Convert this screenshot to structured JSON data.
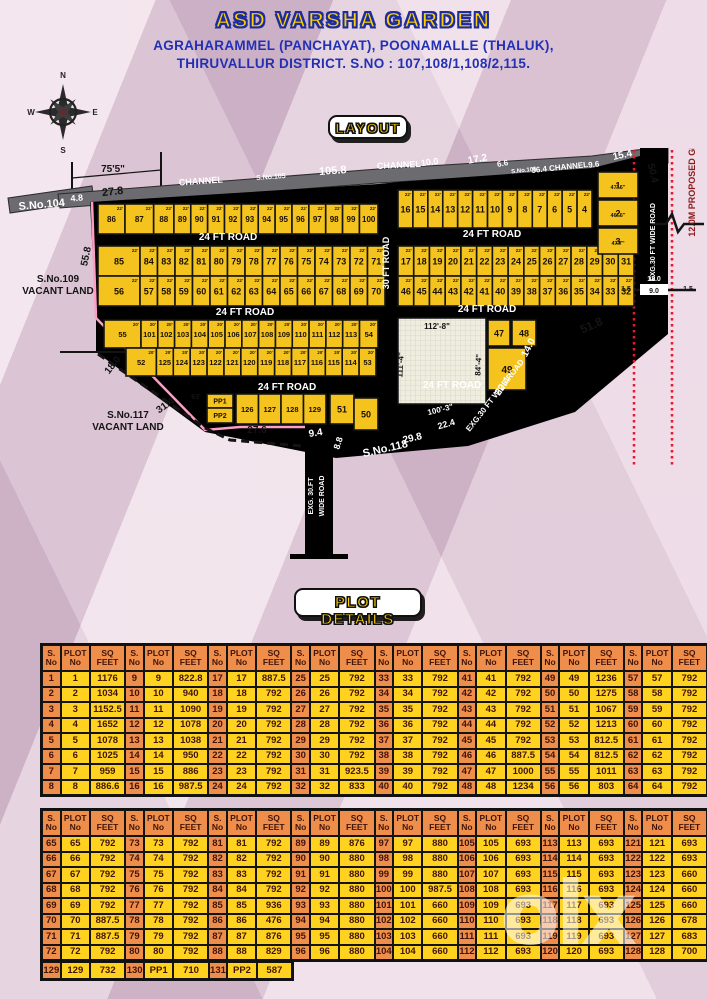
{
  "header": {
    "title": "ASD VARSHA GARDEN",
    "address_line1": "AGRAHARAMMEL (PANCHAYAT), POONAMALLE (THALUK),",
    "address_line2": "THIRUVALLUR DISTRICT.  S.NO : 107,108/1,108/2,115.",
    "layout_badge": "LAYOUT",
    "compass_points": {
      "n": "N",
      "e": "E",
      "s": "S",
      "w": "W"
    }
  },
  "colors": {
    "plot_yellow": "#f4c31d",
    "road_black": "#141414",
    "channel_grey": "#6b6b70",
    "table_orange": "#ef8d4a",
    "table_yellow": "#ffd21f",
    "boundary_pink": "#ff9dc5",
    "grid_road_red": "#e8192c",
    "title_yellow": "#ffd100",
    "title_blue": "#1d2d9e"
  },
  "map": {
    "plot_rows": [
      {
        "labels": [
          "86",
          "87",
          "88",
          "89",
          "90",
          "91",
          "92",
          "93",
          "94",
          "95",
          "96",
          "97",
          "98",
          "99",
          "100"
        ],
        "x0": 98,
        "x1": 378,
        "y": 204,
        "h": 30,
        "fs": 8,
        "w": [
          1.6,
          1.7,
          1.2,
          1,
          1,
          1,
          1,
          1,
          1,
          1,
          1,
          1,
          1,
          1,
          1.1
        ],
        "dim": "22'"
      },
      {
        "labels": [
          "16",
          "15",
          "14",
          "13",
          "12",
          "11",
          "10",
          "9",
          "8",
          "7",
          "6",
          "5",
          "4"
        ],
        "x0": 398,
        "x1": 592,
        "y": 190,
        "h": 38,
        "fs": 9,
        "dim": "22'"
      },
      {
        "labels": [
          "85",
          "84",
          "83",
          "82",
          "81",
          "80",
          "79",
          "78",
          "77",
          "76",
          "75",
          "74",
          "73",
          "72",
          "71"
        ],
        "x0": 98,
        "x1": 385,
        "y": 246,
        "h": 30,
        "fs": 9,
        "w": [
          2.4,
          1,
          1,
          1,
          1,
          1,
          1,
          1,
          1,
          1,
          1,
          1,
          1,
          1,
          1
        ],
        "dim": "22'"
      },
      {
        "labels": [
          "56",
          "57",
          "58",
          "59",
          "60",
          "61",
          "62",
          "63",
          "64",
          "65",
          "66",
          "67",
          "68",
          "69",
          "70"
        ],
        "x0": 98,
        "x1": 385,
        "y": 276,
        "h": 30,
        "fs": 9,
        "w": [
          2.4,
          1,
          1,
          1,
          1,
          1,
          1,
          1,
          1,
          1,
          1,
          1,
          1,
          1,
          1
        ],
        "dim": "22'"
      },
      {
        "labels": [
          "17",
          "18",
          "19",
          "20",
          "21",
          "22",
          "23",
          "24",
          "25",
          "26",
          "27",
          "28",
          "29",
          "30",
          "31"
        ],
        "x0": 398,
        "x1": 634,
        "y": 246,
        "h": 30,
        "fs": 9,
        "dim": "22'"
      },
      {
        "labels": [
          "46",
          "45",
          "44",
          "43",
          "42",
          "41",
          "40",
          "39",
          "38",
          "37",
          "36",
          "35",
          "34",
          "33",
          "32"
        ],
        "x0": 398,
        "x1": 634,
        "y": 276,
        "h": 30,
        "fs": 9,
        "dim": "22'"
      },
      {
        "labels": [
          "55",
          "101",
          "102",
          "103",
          "104",
          "105",
          "106",
          "107",
          "108",
          "109",
          "110",
          "111",
          "112",
          "113",
          "54"
        ],
        "x0": 104,
        "x1": 378,
        "y": 320,
        "h": 28,
        "fs": 7.5,
        "w": [
          2.2,
          1,
          1,
          1,
          1,
          1,
          1,
          1,
          1,
          1,
          1,
          1,
          1,
          1,
          1.1
        ],
        "dim": "20'"
      },
      {
        "labels": [
          "52",
          "125",
          "124",
          "123",
          "122",
          "121",
          "120",
          "119",
          "118",
          "117",
          "116",
          "115",
          "114",
          "53"
        ],
        "x0": 126,
        "x1": 376,
        "y": 348,
        "h": 28,
        "fs": 7.5,
        "w": [
          1.8,
          1,
          1,
          1,
          1,
          1,
          1,
          1,
          1,
          1,
          1,
          1,
          1,
          1
        ],
        "dim": "20'"
      },
      {
        "labels": [
          "126",
          "127",
          "128",
          "129"
        ],
        "x0": 236,
        "x1": 326,
        "y": 394,
        "h": 30,
        "fs": 7.5,
        "dim": ""
      }
    ],
    "special_plots": [
      {
        "l": "PP1",
        "x": 207,
        "y": 394,
        "w": 26,
        "h": 14,
        "fs": 7
      },
      {
        "l": "PP2",
        "x": 207,
        "y": 408,
        "w": 26,
        "h": 15,
        "fs": 7
      },
      {
        "l": "51",
        "x": 330,
        "y": 394,
        "w": 24,
        "h": 30,
        "fs": 9
      },
      {
        "l": "50",
        "x": 354,
        "y": 398,
        "w": 24,
        "h": 32,
        "fs": 9
      },
      {
        "l": "47",
        "x": 488,
        "y": 320,
        "w": 22,
        "h": 26,
        "fs": 9
      },
      {
        "l": "48",
        "x": 512,
        "y": 320,
        "w": 24,
        "h": 26,
        "fs": 9
      },
      {
        "l": "49",
        "x": 488,
        "y": 348,
        "w": 38,
        "h": 42,
        "fs": 10
      },
      {
        "l": "1",
        "x": 598,
        "y": 172,
        "w": 40,
        "h": 26,
        "fs": 9
      },
      {
        "l": "2",
        "x": 598,
        "y": 200,
        "w": 40,
        "h": 26,
        "fs": 9
      },
      {
        "l": "3",
        "x": 598,
        "y": 228,
        "w": 40,
        "h": 26,
        "fs": 9
      }
    ],
    "annotations": [
      {
        "t": "24 FT ROAD",
        "x": 228,
        "y": 240,
        "r": 0,
        "fs": 10,
        "f": "w"
      },
      {
        "t": "24 FT ROAD",
        "x": 492,
        "y": 237,
        "r": 0,
        "fs": 10,
        "f": "w"
      },
      {
        "t": "24 FT ROAD",
        "x": 245,
        "y": 315,
        "r": 0,
        "fs": 10,
        "f": "w"
      },
      {
        "t": "24 FT ROAD",
        "x": 487,
        "y": 312,
        "r": 0,
        "fs": 10,
        "f": "w"
      },
      {
        "t": "24 FT ROAD",
        "x": 287,
        "y": 390,
        "r": 0,
        "fs": 10,
        "f": "w"
      },
      {
        "t": "24 FT ROAD",
        "x": 452,
        "y": 388,
        "r": 0,
        "fs": 10,
        "f": "w"
      },
      {
        "t": "30 FT ROAD",
        "x": 389,
        "y": 263,
        "r": -90,
        "fs": 9,
        "f": "w"
      },
      {
        "t": "EXG. 30.FT",
        "x": 313,
        "y": 496,
        "r": -90,
        "fs": 7,
        "f": "w"
      },
      {
        "t": "WIDE ROAD",
        "x": 324,
        "y": 496,
        "r": -90,
        "fs": 7,
        "f": "w"
      },
      {
        "t": "EXG.30 FT WIDE ROAD",
        "x": 497,
        "y": 397,
        "r": -52,
        "fs": 8,
        "f": "w"
      },
      {
        "t": "EXG.30 FT WIDE ROAD",
        "x": 655,
        "y": 242,
        "r": -90,
        "fs": 7,
        "f": "w"
      },
      {
        "t": "S.No.118",
        "x": 386,
        "y": 452,
        "r": -13,
        "fs": 11,
        "f": "w"
      },
      {
        "t": "9.4",
        "x": 316,
        "y": 436,
        "r": -8,
        "fs": 10,
        "f": "w"
      },
      {
        "t": "8.8",
        "x": 341,
        "y": 444,
        "r": -72,
        "fs": 9,
        "f": "w"
      },
      {
        "t": "29.8",
        "x": 413,
        "y": 441,
        "r": -13,
        "fs": 10,
        "f": "w"
      },
      {
        "t": "22.4",
        "x": 447,
        "y": 427,
        "r": -16,
        "fs": 9,
        "f": "w"
      },
      {
        "t": "100'-3\"",
        "x": 441,
        "y": 412,
        "r": -14,
        "fs": 8,
        "f": "w"
      },
      {
        "t": "22.4",
        "x": 505,
        "y": 388,
        "r": -56,
        "fs": 10,
        "f": "w"
      },
      {
        "t": "14.0",
        "x": 531,
        "y": 349,
        "r": -63,
        "fs": 10,
        "f": "w"
      },
      {
        "t": "12.0",
        "x": 654,
        "y": 119,
        "r": 0,
        "fs": 7,
        "f": "w"
      },
      {
        "t": "12.0",
        "x": 654,
        "y": 281,
        "r": 0,
        "fs": 7,
        "f": "w"
      },
      {
        "t": "CHANNEL",
        "x": 201,
        "y": 184,
        "r": -4,
        "fs": 9,
        "f": "w"
      },
      {
        "t": "S.No.105",
        "x": 271,
        "y": 179,
        "r": -4,
        "fs": 7,
        "f": "w"
      },
      {
        "t": "105.8",
        "x": 333,
        "y": 174,
        "r": -4,
        "fs": 11,
        "f": "w"
      },
      {
        "t": "CHANNEL",
        "x": 399,
        "y": 168,
        "r": -3,
        "fs": 9,
        "f": "w"
      },
      {
        "t": "10.0",
        "x": 430,
        "y": 165,
        "r": -8,
        "fs": 9,
        "f": "w"
      },
      {
        "t": "17.2",
        "x": 478,
        "y": 162,
        "r": -10,
        "fs": 10,
        "f": "w"
      },
      {
        "t": "6.6",
        "x": 503,
        "y": 166,
        "r": -10,
        "fs": 8,
        "f": "w"
      },
      {
        "t": "S.No.106",
        "x": 524,
        "y": 172,
        "r": -6,
        "fs": 6,
        "f": "w"
      },
      {
        "t": "36.4 CHANNEL",
        "x": 560,
        "y": 170,
        "r": -6,
        "fs": 8,
        "f": "w"
      },
      {
        "t": "9.6",
        "x": 594,
        "y": 167,
        "r": -6,
        "fs": 8,
        "f": "w"
      },
      {
        "t": "15.4",
        "x": 623,
        "y": 158,
        "r": -12,
        "fs": 10,
        "f": "w"
      },
      {
        "t": "S.No.104",
        "x": 42,
        "y": 208,
        "r": -5,
        "fs": 11,
        "f": "w"
      },
      {
        "t": "4.8",
        "x": 77,
        "y": 201,
        "r": -5,
        "fs": 9,
        "f": "w"
      },
      {
        "t": "75'5\"",
        "x": 113,
        "y": 172,
        "r": 0,
        "fs": 10,
        "f": "b"
      },
      {
        "t": "27.8",
        "x": 113,
        "y": 195,
        "r": -6,
        "fs": 11,
        "f": "b"
      },
      {
        "t": "55.8",
        "x": 89,
        "y": 257,
        "r": -78,
        "fs": 10,
        "f": "b"
      },
      {
        "t": "S.No.109",
        "x": 58,
        "y": 282,
        "r": 0,
        "fs": 10,
        "f": "b"
      },
      {
        "t": "VACANT LAND",
        "x": 58,
        "y": 294,
        "r": 0,
        "fs": 10,
        "f": "b"
      },
      {
        "t": "S.No.117",
        "x": 128,
        "y": 418,
        "r": 0,
        "fs": 10,
        "f": "b"
      },
      {
        "t": "VACANT LAND",
        "x": 128,
        "y": 430,
        "r": 0,
        "fs": 10,
        "f": "b"
      },
      {
        "t": "18.0",
        "x": 115,
        "y": 367,
        "r": -52,
        "fs": 10,
        "f": "b"
      },
      {
        "t": "31.4",
        "x": 167,
        "y": 408,
        "r": -35,
        "fs": 10,
        "f": "b"
      },
      {
        "t": "27.6",
        "x": 257,
        "y": 433,
        "r": 0,
        "fs": 10,
        "f": "b"
      },
      {
        "t": "51.8",
        "x": 593,
        "y": 329,
        "r": -24,
        "fs": 12,
        "f": "b"
      },
      {
        "t": "50.4",
        "x": 650,
        "y": 174,
        "r": 76,
        "fs": 10,
        "f": "b"
      },
      {
        "t": "63'",
        "x": 196,
        "y": 399,
        "r": 0,
        "fs": 7,
        "f": "b"
      },
      {
        "t": "112'-8\"",
        "x": 437,
        "y": 329,
        "r": 0,
        "fs": 8,
        "f": "b"
      },
      {
        "t": "111'-4\"",
        "x": 403,
        "y": 365,
        "r": -87,
        "fs": 8,
        "f": "b"
      },
      {
        "t": "84'-4\"",
        "x": 481,
        "y": 365,
        "r": -87,
        "fs": 8,
        "f": "b"
      },
      {
        "t": "47'-6\"",
        "x": 618,
        "y": 189,
        "r": 0,
        "fs": 5.5,
        "f": "b"
      },
      {
        "t": "46'-6\"",
        "x": 618,
        "y": 217,
        "r": 0,
        "fs": 5.5,
        "f": "b"
      },
      {
        "t": "47'7\"",
        "x": 618,
        "y": 245,
        "r": 0,
        "fs": 5.5,
        "f": "b"
      },
      {
        "t": "1.5",
        "x": 627,
        "y": 128,
        "r": 0,
        "fs": 7,
        "f": "b"
      },
      {
        "t": "1.5",
        "x": 680,
        "y": 128,
        "r": 0,
        "fs": 7,
        "f": "b"
      },
      {
        "t": "1.5",
        "x": 626,
        "y": 291,
        "r": 0,
        "fs": 7,
        "f": "b"
      },
      {
        "t": "1.5",
        "x": 688,
        "y": 291,
        "r": 0,
        "fs": 7,
        "f": "b"
      },
      {
        "t": "9.0",
        "x": 654,
        "y": 131,
        "r": 0,
        "fs": 7,
        "f": "b"
      },
      {
        "t": "9.0",
        "x": 654,
        "y": 293,
        "r": 0,
        "fs": 7,
        "f": "b"
      },
      {
        "t": "12.0M PROPOSED GRID OF ROAD",
        "x": 695,
        "y": 163,
        "r": -90,
        "fs": 9,
        "f": "m"
      }
    ]
  },
  "plot_details": {
    "badge": "PLOT DETAILS",
    "col_headers": [
      "S.\nNo",
      "PLOT\nNo",
      "SQ\nFEET"
    ],
    "table1_start": 1,
    "table1_sqfeet": [
      "1176",
      "1034",
      "1152.5",
      "1652",
      "1078",
      "1025",
      "959",
      "886.6",
      "822.8",
      "940",
      "1090",
      "1078",
      "1038",
      "950",
      "886",
      "987.5",
      "887.5",
      "792",
      "792",
      "792",
      "792",
      "792",
      "792",
      "792",
      "792",
      "792",
      "792",
      "792",
      "792",
      "792",
      "923.5",
      "833",
      "792",
      "792",
      "792",
      "792",
      "792",
      "792",
      "792",
      "792",
      "792",
      "792",
      "792",
      "792",
      "792",
      "887.5",
      "1000",
      "1234",
      "1236",
      "1275",
      "1067",
      "1213",
      "812.5",
      "812.5",
      "1011",
      "803",
      "792",
      "792",
      "792",
      "792",
      "792",
      "792",
      "792",
      "792"
    ],
    "table2_start": 65,
    "table2_sqfeet": [
      "792",
      "792",
      "792",
      "792",
      "792",
      "887.5",
      "887.5",
      "792",
      "792",
      "792",
      "792",
      "792",
      "792",
      "792",
      "792",
      "792",
      "792",
      "792",
      "792",
      "792",
      "936",
      "476",
      "876",
      "829",
      "876",
      "880",
      "880",
      "880",
      "880",
      "880",
      "880",
      "880",
      "880",
      "880",
      "880",
      "987.5",
      "660",
      "660",
      "660",
      "660",
      "693",
      "693",
      "693",
      "693",
      "693",
      "693",
      "693",
      "693",
      "693",
      "693",
      "693",
      "693",
      "693",
      "693",
      "693",
      "693",
      "693",
      "693",
      "660",
      "660",
      "660",
      "678",
      "683",
      "700"
    ],
    "table3_rows": [
      {
        "s": "129",
        "plot": "129",
        "sq": "732"
      },
      {
        "s": "130",
        "plot": "PP1",
        "sq": "710"
      },
      {
        "s": "131",
        "plot": "PP2",
        "sq": "587"
      }
    ]
  },
  "watermark": "olx"
}
